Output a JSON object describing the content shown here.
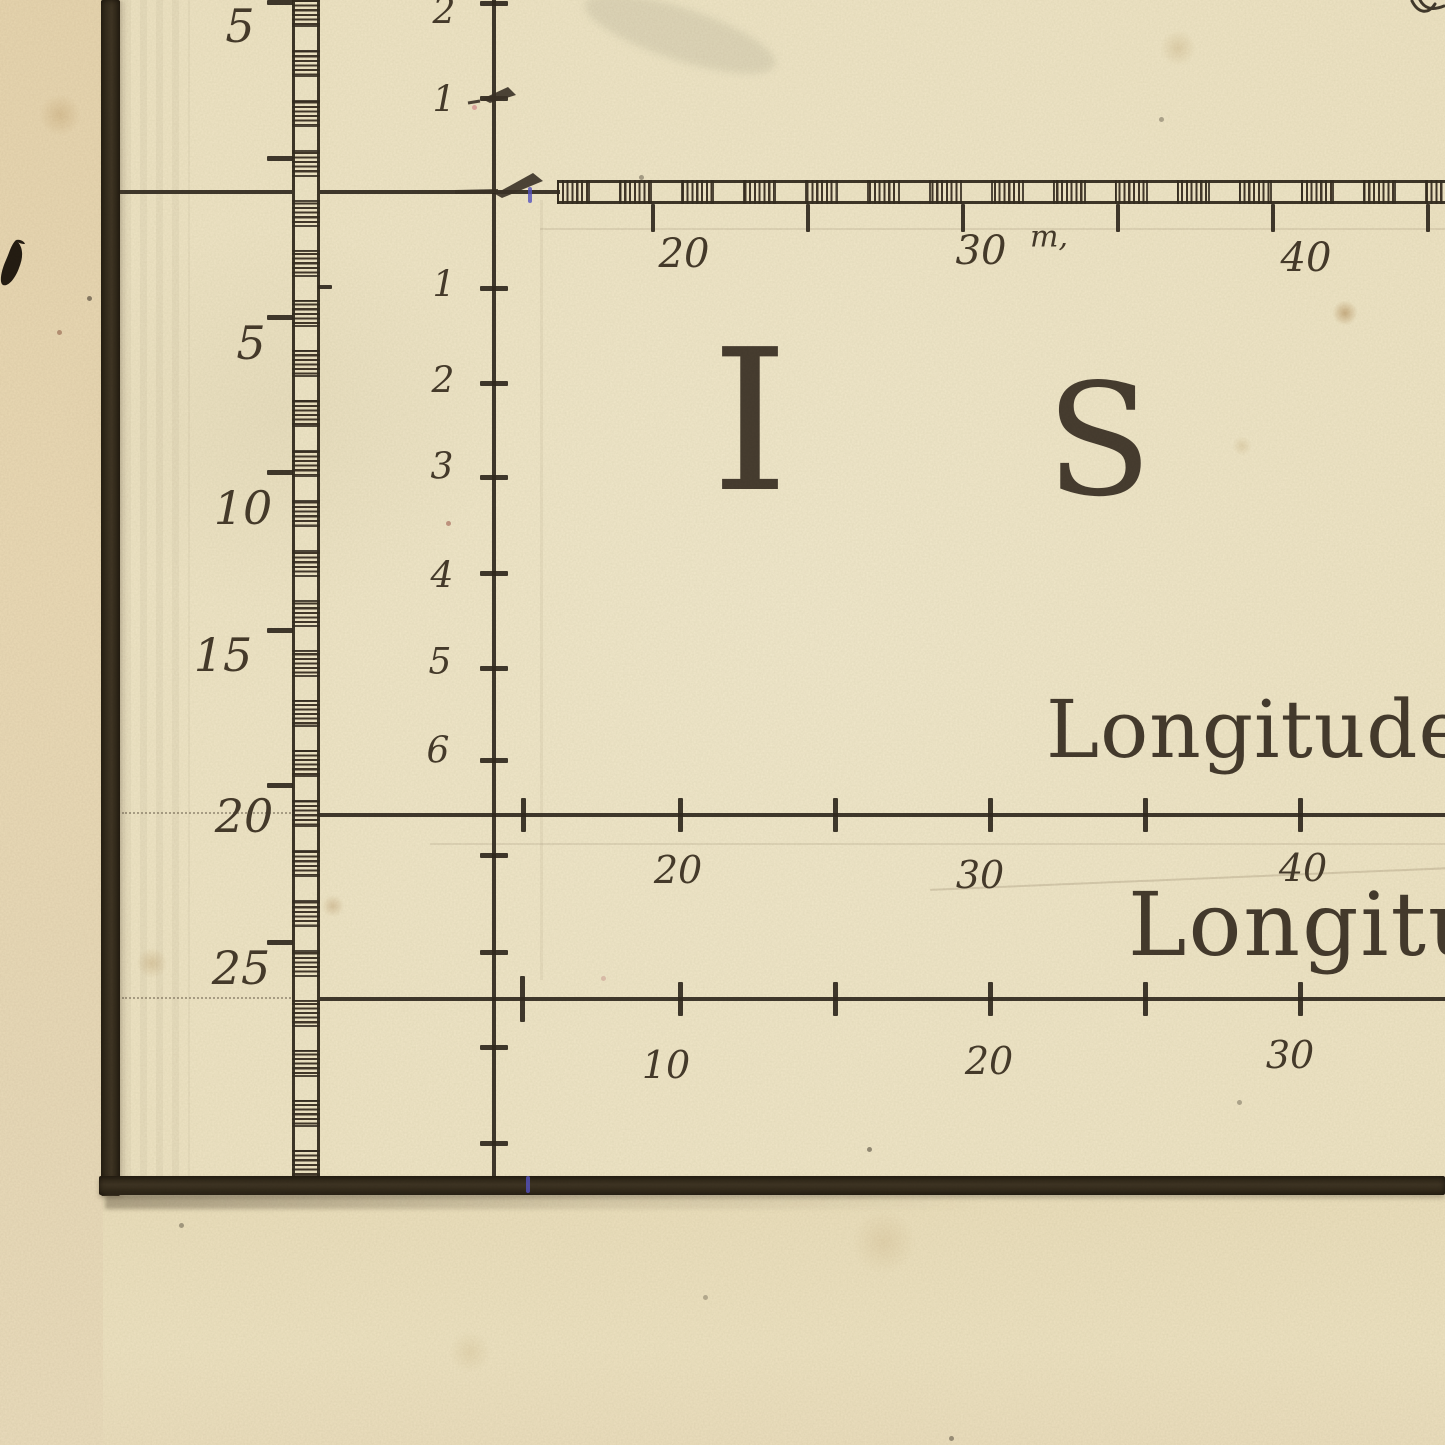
{
  "map_title": {
    "letters": [
      "I",
      "S"
    ]
  },
  "outer_latitude_scale": {
    "labels": [
      "5",
      "5",
      "10",
      "15",
      "20",
      "25"
    ]
  },
  "inner_minute_scale": {
    "labels_above_corner": [
      "2",
      "1"
    ],
    "labels_below_corner": [
      "1",
      "2",
      "3",
      "4",
      "5",
      "6"
    ]
  },
  "top_minute_scale": {
    "labels": [
      "20",
      "30",
      "40"
    ],
    "unit_label": "m,"
  },
  "upper_longitude_scale": {
    "caption": "Longitude",
    "labels": [
      "20",
      "30",
      "40"
    ]
  },
  "lower_longitude_scale": {
    "caption": "Longitude",
    "labels": [
      "10",
      "20",
      "30"
    ]
  },
  "colors": {
    "paper": "#efe6c7",
    "margin_paper": "#e9d8b4",
    "ink": "#3a3126",
    "annotation_blue": "#5654c4"
  }
}
